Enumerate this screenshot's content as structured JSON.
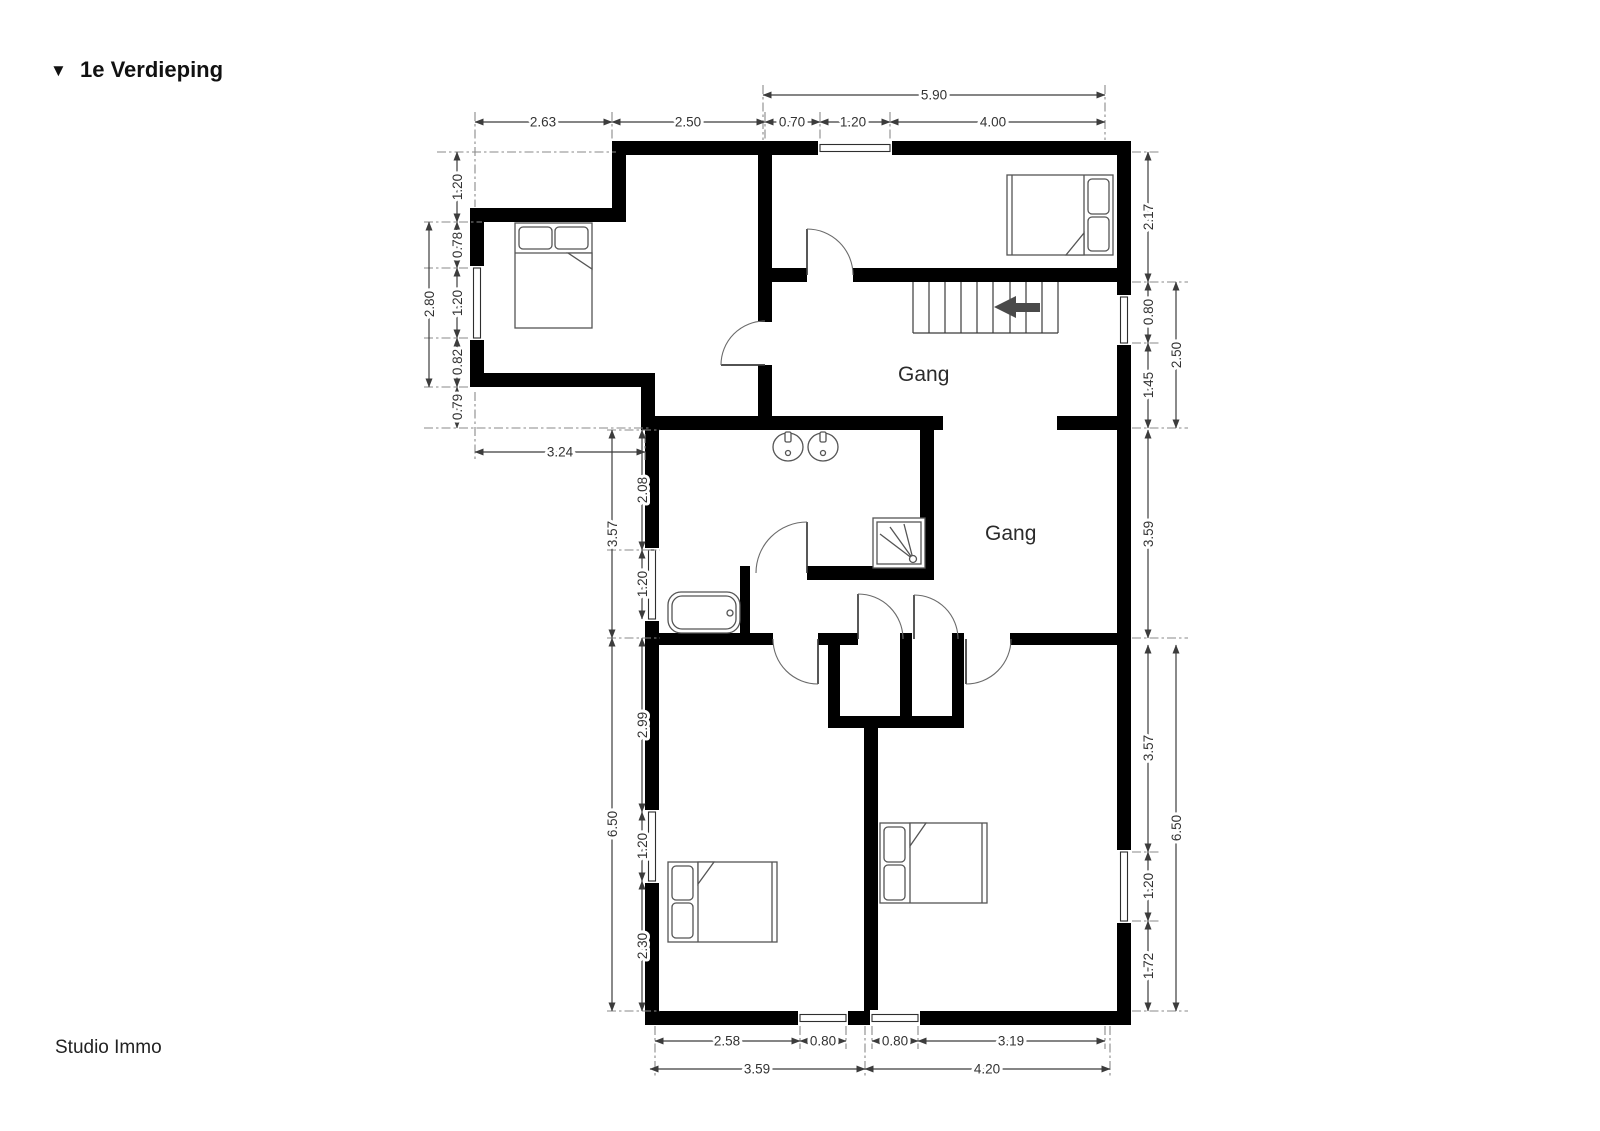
{
  "title": {
    "marker": "▼",
    "text": "1e Verdieping"
  },
  "footer": {
    "text": "Studio Immo"
  },
  "rooms": {
    "hall_upper": "Gang",
    "hall_lower": "Gang"
  },
  "dims": {
    "top_outer": [
      "5.90"
    ],
    "top_inner": [
      "2.63",
      "2.50",
      "0.70",
      "1.20",
      "4.00"
    ],
    "left_upper_inner": [
      "1.20",
      "0.78",
      "1.20",
      "0.82",
      "0.79"
    ],
    "left_upper_outer": [
      "2.80"
    ],
    "left_room_width": [
      "3.24"
    ],
    "left_bath_inner": [
      "2.08",
      "1.20"
    ],
    "left_bath_outer": [
      "3.57"
    ],
    "left_lower_inner": [
      "2.99",
      "1.20",
      "2.30"
    ],
    "left_lower_outer": [
      "6.50"
    ],
    "right_upper_inner": [
      "2.17",
      "0.80",
      "1.45"
    ],
    "right_upper_outer": [
      "2.50"
    ],
    "right_mid": [
      "3.59"
    ],
    "right_lower_inner": [
      "3.57",
      "1.20",
      "1.72"
    ],
    "right_lower_outer": [
      "6.50"
    ],
    "bottom_inner": [
      "2.58",
      "0.80",
      "0.80",
      "3.19"
    ],
    "bottom_outer": [
      "3.59",
      "4.20"
    ]
  }
}
